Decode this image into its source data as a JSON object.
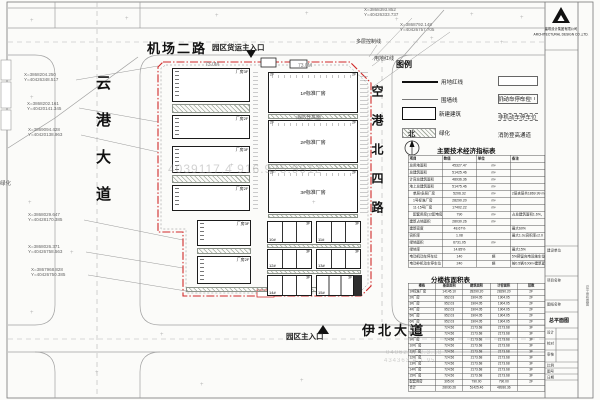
{
  "roads": {
    "top": "机场二路",
    "left": "云港大道",
    "right": "空港北四路",
    "bottom": "伊北大道"
  },
  "entrances": {
    "freight": "园区货运主入口",
    "main": "园区主入口"
  },
  "boundary": {
    "control_line": "多层控制线",
    "red_line": "用地红线",
    "red_color": "#d02a2a"
  },
  "north_label": "北",
  "margin_green_label": "绿化",
  "watermark": {
    "center": "4039117.4 916.975.9912",
    "corner1": "04062/W 2.3.18",
    "corner2": "434363.4 1.95"
  },
  "dims": [
    "73.0M",
    "73.0M"
  ],
  "coordinates": [
    {
      "x": "X=3868204.250",
      "y": "Y=40426348.517"
    },
    {
      "x": "X=3868202.161",
      "y": "Y=40420141.345"
    },
    {
      "x": "X=3869094.428",
      "y": "Y=40420138.963"
    },
    {
      "x": "X=3868029.647",
      "y": "Y=40428170.385"
    },
    {
      "x": "X=3868026.371",
      "y": "Y=40426758.563"
    },
    {
      "x": "X=3867968.828",
      "y": "Y=40426750.385"
    },
    {
      "x": "X=3868393.852",
      "y": "Y=40426333.737"
    },
    {
      "x": "X=3868792.148",
      "y": "Y=40426757.705"
    }
  ],
  "legend": {
    "title": "图例",
    "left": [
      {
        "label": "用地红线"
      },
      {
        "label": "围墙线"
      },
      {
        "label": "新建建筑"
      },
      {
        "label": "绿化"
      }
    ],
    "right": [
      {
        "label": "机动车停车位"
      },
      {
        "label": "非机动车停车位"
      },
      {
        "label": "消防登高通道"
      }
    ]
  },
  "buildings": {
    "left": [
      "厂房3F",
      "厂房2F",
      "厂房3F",
      "厂房2F",
      "厂房3F",
      "厂房2F"
    ],
    "right": [
      {
        "name": "1#标准厂房",
        "floors": "2F"
      },
      {
        "name": "2#标准厂房",
        "floors": "2F"
      },
      {
        "name": "3#标准厂房",
        "floors": "2F"
      }
    ],
    "units": [
      "10#",
      "11#",
      "12#",
      "13#",
      "14#",
      "15#"
    ],
    "unit_floors": "3F",
    "fire_lane_label": "消防登高面"
  },
  "main_table": {
    "title": "主要技术经济指标表",
    "headers": [
      "项目",
      "数值",
      "单位",
      "备注"
    ],
    "rows": [
      [
        "总用地面积",
        "45327.47",
        "m²",
        ""
      ],
      [
        "总建筑面积",
        "51425.46",
        "m²",
        ""
      ],
      [
        "计容总建筑面积",
        "48936.36",
        "m²",
        ""
      ],
      [
        "地上总建筑面积",
        "51475.46",
        "m²",
        ""
      ],
      [
        "　单层/多层厂房",
        "5206.32",
        "m²",
        "2层夹层共1869.99 m²"
      ],
      [
        "　1号标准厂房",
        "28290.20",
        "m²",
        ""
      ],
      [
        "　11-15号厂房",
        "17402.22",
        "m²",
        ""
      ],
      [
        "　配套用房(12配电房与消防泵房)",
        "790",
        "m²",
        "占总建筑面积1.6%，最大5%"
      ],
      [
        "建筑占地面积",
        "28030.26",
        "m²",
        ""
      ],
      [
        "建筑密度",
        "48.67%",
        "",
        "最大60%"
      ],
      [
        "容积率",
        "1.08",
        "",
        "最大1.0≤容积率≤2.0"
      ],
      [
        "绿地面积",
        "6731.05",
        "m²",
        ""
      ],
      [
        "绿地率",
        "14.85%",
        "",
        "最大15%"
      ],
      [
        "电动机动车停车位",
        "140",
        "辆",
        "5%预留充电设施车位"
      ],
      [
        "电动非机动车停车位",
        "240",
        "辆",
        "按0.5辆/100m²建筑面积配置"
      ]
    ]
  },
  "area_table": {
    "title": "分楼栋面积表",
    "headers": [
      "楼栋",
      "基底面积",
      "建筑面积",
      "计容面积",
      "层数"
    ],
    "rows": [
      [
        "1#标准厂房",
        "14145.10",
        "28290.20",
        "28290.20",
        "2F"
      ],
      [
        "2#厂房",
        "952.03",
        "1904.05",
        "1904.05",
        "2F"
      ],
      [
        "3#厂房",
        "952.03",
        "1904.05",
        "1904.05",
        "2F"
      ],
      [
        "4#厂房",
        "952.03",
        "1904.05",
        "1904.05",
        "2F"
      ],
      [
        "5#厂房",
        "952.03",
        "1904.05",
        "1904.05",
        "2F"
      ],
      [
        "6#厂房",
        "952.03",
        "1904.05",
        "1904.05",
        "2F"
      ],
      [
        "7#厂房",
        "724.56",
        "2173.68",
        "2173.68",
        "3F"
      ],
      [
        "8#厂房",
        "724.56",
        "2173.68",
        "2173.68",
        "3F"
      ],
      [
        "9#厂房",
        "724.56",
        "2173.68",
        "2173.68",
        "3F"
      ],
      [
        "10#厂房",
        "724.56",
        "2173.68",
        "2173.68",
        "3F"
      ],
      [
        "11#厂房",
        "724.56",
        "2173.68",
        "2173.68",
        "3F"
      ],
      [
        "12#厂房",
        "724.56",
        "2173.68",
        "2173.68",
        "3F"
      ],
      [
        "13#厂房",
        "724.56",
        "2173.68",
        "2173.68",
        "3F"
      ],
      [
        "14#厂房",
        "724.56",
        "2173.68",
        "2173.68",
        "3F"
      ],
      [
        "15#厂房",
        "724.56",
        "2173.68",
        "2173.68",
        "3F"
      ],
      [
        "配套用房",
        "395.00",
        "790.00",
        "790.00",
        "2F"
      ],
      [
        "合计",
        "28030.26",
        "51425.46",
        "48936.36",
        ""
      ]
    ]
  },
  "titleblock": {
    "company": "建筑设计集团有限公司",
    "company_en": "ARCHITECTURAL DESIGN CO.,LTD.",
    "client_label": "建设单位",
    "project_label": "项目名称",
    "drawing_label": "图纸名称",
    "drawing_name": "总平面图",
    "design_label": "设计",
    "check_label": "校对",
    "review_label": "审核",
    "scale_label": "比例",
    "no_label": "图号",
    "date_label": "日期",
    "side_text": "总平面布置图"
  }
}
